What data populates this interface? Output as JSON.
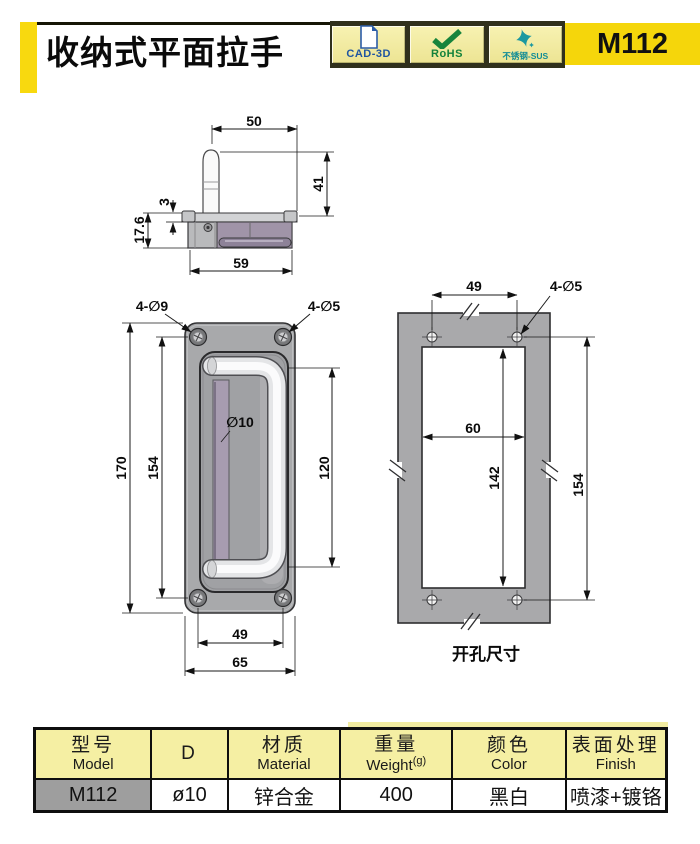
{
  "header": {
    "title": "收纳式平面拉手",
    "model": "M112",
    "badges": [
      {
        "label": "CAD-3D",
        "icon": "document-page"
      },
      {
        "label": "RoHS",
        "icon": "checkmark"
      },
      {
        "label": "不锈钢-SUS",
        "icon": "sparkle-star"
      }
    ]
  },
  "colors": {
    "accent_yellow": "#F5D60B",
    "badge_yellow": "#F2EC9E",
    "badge_strip_dark": "#30301C",
    "table_header_yellow": "#F5EFA3",
    "model_cell_gray": "#9E9E9E",
    "drawing_gray": "#A8A9AB",
    "cad_blue": "#1F55A0",
    "rohs_green": "#13823B",
    "sus_teal": "#128C96"
  },
  "side_view": {
    "dim_top_width": "50",
    "dim_height": "41",
    "dim_flange_thickness": "3",
    "dim_depth": "17.6",
    "dim_body_width": "59"
  },
  "front_view": {
    "label_corner_holes": "4-∅9",
    "label_small_holes": "4-∅5",
    "label_bar_diameter": "∅10",
    "dim_plate_height": "170",
    "dim_hole_span_vertical": "154",
    "dim_handle_span": "120",
    "dim_hole_span_horizontal": "49",
    "dim_plate_width": "65"
  },
  "cutout_view": {
    "caption": "开孔尺寸",
    "label_holes": "4-∅5",
    "dim_hole_span_horizontal": "49",
    "dim_cutout_width": "60",
    "dim_cutout_height": "142",
    "dim_hole_span_vertical": "154"
  },
  "spec_table": {
    "columns": [
      {
        "zh": "型号",
        "en": "Model"
      },
      {
        "zh": "D",
        "en": ""
      },
      {
        "zh": "材质",
        "en": "Material"
      },
      {
        "zh": "重量",
        "en": "Weight",
        "unit": "(g)"
      },
      {
        "zh": "颜色",
        "en": "Color"
      },
      {
        "zh": "表面处理",
        "en": "Finish"
      }
    ],
    "row": {
      "model": "M112",
      "d": "ø10",
      "material": "锌合金",
      "weight": "400",
      "color": "黑白",
      "finish": "喷漆+镀铬"
    }
  }
}
